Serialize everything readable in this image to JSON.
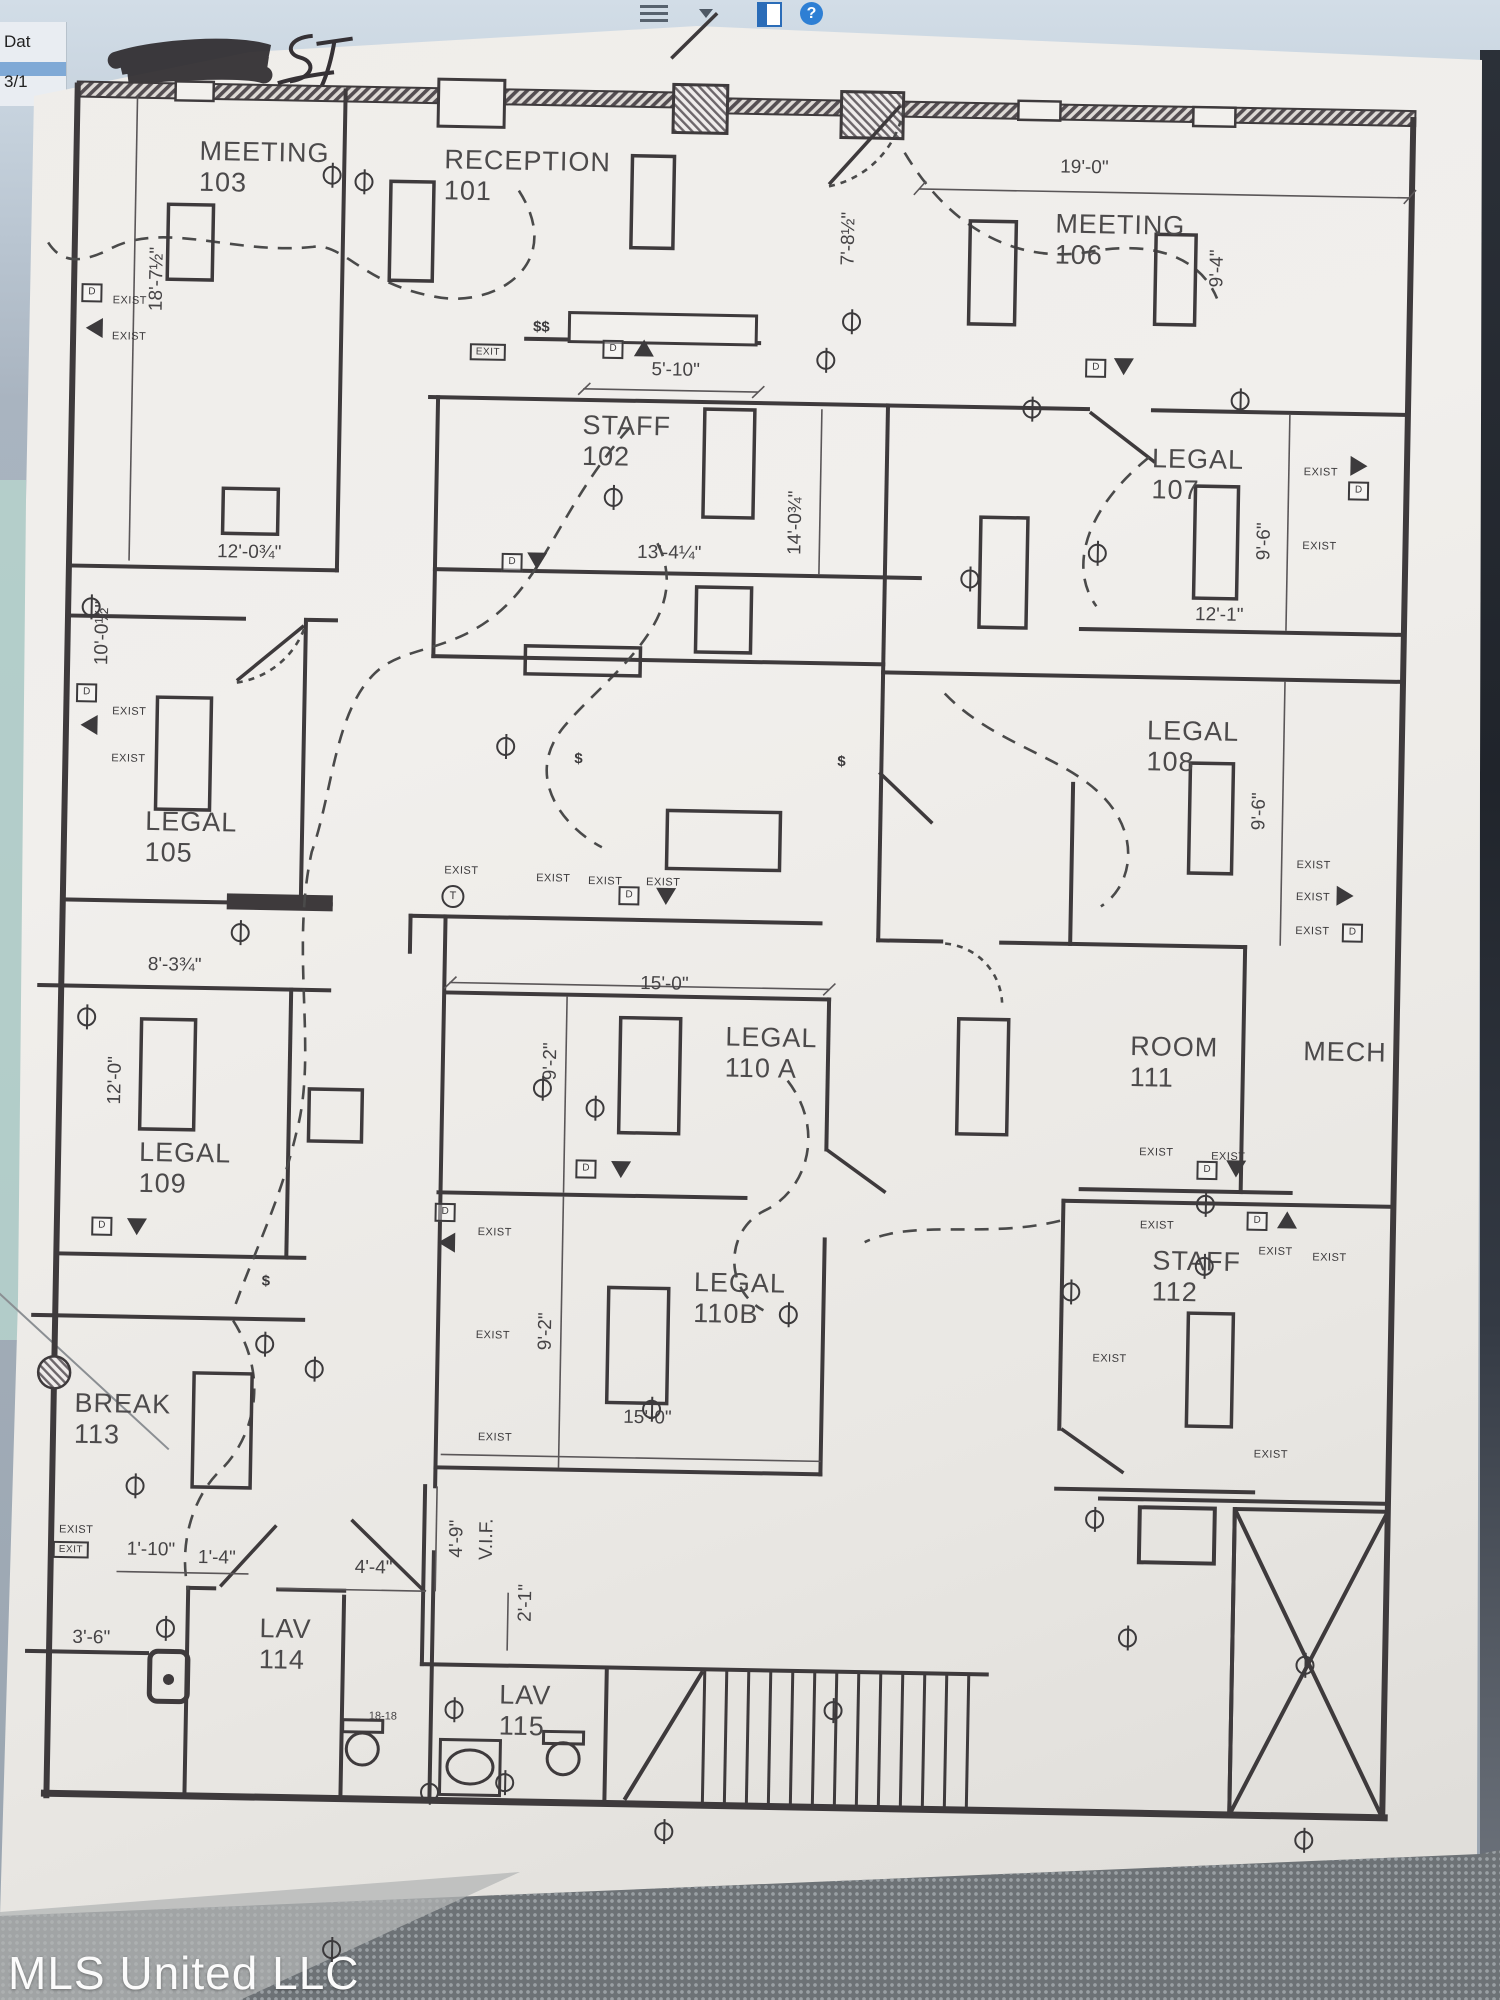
{
  "screen": {
    "spreadsheet_fragment": {
      "row1": "Dat",
      "row2": "3/1"
    },
    "icons": [
      {
        "name": "menu-lines-icon"
      },
      {
        "name": "dropdown-arrow-icon"
      },
      {
        "name": "window-split-icon"
      },
      {
        "name": "help-badge-icon",
        "glyph": "?"
      }
    ],
    "watermark": "MLS United LLC"
  },
  "plan": {
    "handwritten_mark": "ST",
    "glyphs": {
      "exist": "EXIST",
      "exit": "EXIT",
      "door_tag": "D",
      "thermostat": "T",
      "switch": "$",
      "double_switch": "$$"
    },
    "rooms": [
      {
        "name": "MEETING",
        "num": "103",
        "x": 185,
        "y": 146
      },
      {
        "name": "RECEPTION",
        "num": "101",
        "x": 430,
        "y": 150
      },
      {
        "name": "MEETING",
        "num": "106",
        "x": 1042,
        "y": 203
      },
      {
        "name": "STAFF",
        "num": "102",
        "x": 573,
        "y": 413
      },
      {
        "name": "LEGAL",
        "num": "107",
        "x": 1143,
        "y": 436
      },
      {
        "name": "LEGAL",
        "num": "108",
        "x": 1143,
        "y": 708
      },
      {
        "name": "LEGAL",
        "num": "105",
        "x": 143,
        "y": 817
      },
      {
        "name": "LEGAL",
        "num": "110 A",
        "x": 727,
        "y": 1022
      },
      {
        "name": "ROOM",
        "num": "111",
        "x": 1132,
        "y": 1024
      },
      {
        "name": "MECH",
        "num": "",
        "x": 1305,
        "y": 1026
      },
      {
        "name": "LEGAL",
        "num": "109",
        "x": 143,
        "y": 1148
      },
      {
        "name": "STAFF",
        "num": "112",
        "x": 1158,
        "y": 1238
      },
      {
        "name": "LEGAL",
        "num": "110B",
        "x": 700,
        "y": 1268
      },
      {
        "name": "BREAK",
        "num": "113",
        "x": 83,
        "y": 1400
      },
      {
        "name": "LAV",
        "num": "114",
        "x": 272,
        "y": 1622
      },
      {
        "name": "LAV",
        "num": "115",
        "x": 513,
        "y": 1684
      }
    ],
    "dimensions": [
      {
        "t": "19'-0\"",
        "x": 1070,
        "y": 162,
        "r": 0
      },
      {
        "t": "9'-4\"",
        "x": 1205,
        "y": 260,
        "r": -90
      },
      {
        "t": "7'-8½\"",
        "x": 836,
        "y": 237,
        "r": -90
      },
      {
        "t": "18'-7½\"",
        "x": 145,
        "y": 290,
        "r": -90
      },
      {
        "t": "5'-10\"",
        "x": 665,
        "y": 372,
        "r": 0
      },
      {
        "t": "12'-0¾\"",
        "x": 242,
        "y": 562,
        "r": 0
      },
      {
        "t": "13'-4¼\"",
        "x": 662,
        "y": 555,
        "r": 0
      },
      {
        "t": "14'-0¾\"",
        "x": 788,
        "y": 522,
        "r": -90
      },
      {
        "t": "9'-6\"",
        "x": 1257,
        "y": 532,
        "r": -90
      },
      {
        "t": "12'-1\"",
        "x": 1213,
        "y": 607,
        "r": 0
      },
      {
        "t": "10'-0½\"",
        "x": 97,
        "y": 645,
        "r": -90
      },
      {
        "t": "9'-6\"",
        "x": 1257,
        "y": 802,
        "r": -90
      },
      {
        "t": "8'-3¾\"",
        "x": 175,
        "y": 976,
        "r": 0
      },
      {
        "t": "15'-0\"",
        "x": 665,
        "y": 986,
        "r": 0
      },
      {
        "t": "9'-2\"",
        "x": 553,
        "y": 1065,
        "r": -90
      },
      {
        "t": "12'-0\"",
        "x": 118,
        "y": 1092,
        "r": -90
      },
      {
        "t": "9'-2\"",
        "x": 553,
        "y": 1335,
        "r": -90
      },
      {
        "t": "15'-0\"",
        "x": 656,
        "y": 1420,
        "r": 0
      },
      {
        "t": "4'-9\"",
        "x": 468,
        "y": 1544,
        "r": -90
      },
      {
        "t": "V.I.F.",
        "x": 498,
        "y": 1544,
        "r": -90
      },
      {
        "t": "2'-1\"",
        "x": 538,
        "y": 1607,
        "r": -90
      },
      {
        "t": "1'-10\"",
        "x": 162,
        "y": 1561,
        "r": 0
      },
      {
        "t": "1'-4\"",
        "x": 228,
        "y": 1568,
        "r": 0
      },
      {
        "t": "4'-4\"",
        "x": 385,
        "y": 1575,
        "r": 0
      },
      {
        "t": "3'-6\"",
        "x": 104,
        "y": 1650,
        "r": 0
      },
      {
        "t": "18-18",
        "x": 397,
        "y": 1723,
        "r": 0,
        "s": 1
      }
    ],
    "exist_labels": [
      [
        118,
        312
      ],
      [
        118,
        348
      ],
      [
        125,
        723
      ],
      [
        125,
        770
      ],
      [
        1312,
        462
      ],
      [
        1312,
        536
      ],
      [
        1312,
        855
      ],
      [
        1312,
        887
      ],
      [
        1312,
        921
      ],
      [
        460,
        876
      ],
      [
        552,
        882
      ],
      [
        604,
        884
      ],
      [
        662,
        884
      ],
      [
        500,
        1237
      ],
      [
        500,
        1340
      ],
      [
        504,
        1442
      ],
      [
        1160,
        1145
      ],
      [
        1232,
        1148
      ],
      [
        1281,
        1242
      ],
      [
        1335,
        1247
      ],
      [
        1162,
        1218
      ],
      [
        1117,
        1352
      ],
      [
        1280,
        1445
      ],
      [
        87,
        1542
      ]
    ],
    "exit_boxes": [
      [
        477,
        357
      ],
      [
        82,
        1562
      ]
    ],
    "t_circles": [
      [
        452,
        902
      ]
    ],
    "d_boxes": [
      [
        602,
        352
      ],
      [
        1085,
        362
      ],
      [
        505,
        567
      ],
      [
        82,
        705
      ],
      [
        450,
        1218
      ],
      [
        107,
        1238
      ],
      [
        628,
        898
      ],
      [
        590,
        1172
      ],
      [
        1211,
        1162
      ],
      [
        1262,
        1212
      ],
      [
        1352,
        922
      ],
      [
        1350,
        480
      ],
      [
        80,
        305
      ]
    ],
    "triangles": [
      {
        "d": "up",
        "x": 633,
        "y": 350
      },
      {
        "d": "up",
        "x": 1292,
        "y": 1210
      },
      {
        "d": "down",
        "x": 1113,
        "y": 360
      },
      {
        "d": "down",
        "x": 530,
        "y": 565
      },
      {
        "d": "down",
        "x": 665,
        "y": 898
      },
      {
        "d": "down",
        "x": 625,
        "y": 1172
      },
      {
        "d": "down",
        "x": 1240,
        "y": 1160
      },
      {
        "d": "down",
        "x": 142,
        "y": 1238
      },
      {
        "d": "left",
        "x": 85,
        "y": 737
      },
      {
        "d": "left",
        "x": 452,
        "y": 1248
      },
      {
        "d": "left",
        "x": 83,
        "y": 340
      },
      {
        "d": "right",
        "x": 1350,
        "y": 455
      },
      {
        "d": "right",
        "x": 1344,
        "y": 885
      }
    ],
    "dollar_marks": [
      {
        "t": "double_switch",
        "x": 530,
        "y": 331
      },
      {
        "t": "switch",
        "x": 575,
        "y": 762
      },
      {
        "t": "switch",
        "x": 272,
        "y": 1290
      },
      {
        "t": "switch",
        "x": 838,
        "y": 760
      }
    ],
    "phis": [
      [
        318,
        183
      ],
      [
        350,
        170
      ],
      [
        840,
        282
      ],
      [
        815,
        302
      ],
      [
        1022,
        328
      ],
      [
        1230,
        297
      ],
      [
        1090,
        433
      ],
      [
        963,
        442
      ],
      [
        605,
        348
      ],
      [
        502,
        580
      ],
      [
        545,
        902
      ],
      [
        598,
        902
      ],
      [
        660,
        1183
      ],
      [
        85,
        372
      ],
      [
        88,
        763
      ],
      [
        240,
        657
      ],
      [
        795,
        1010
      ],
      [
        1077,
        963
      ],
      [
        520,
        1445
      ],
      [
        680,
        1472
      ],
      [
        1320,
        1450
      ],
      [
        178,
        1240
      ],
      [
        1140,
        1213
      ],
      [
        1318,
        1218
      ],
      [
        445,
        1342
      ],
      [
        468,
        1240
      ],
      [
        145,
        1003
      ],
      [
        272,
        840
      ],
      [
        322,
        845
      ],
      [
        1210,
        645
      ],
      [
        1210,
        688
      ],
      [
        847,
        1120
      ],
      [
        1105,
        905
      ],
      [
        350,
        1330
      ]
    ]
  }
}
